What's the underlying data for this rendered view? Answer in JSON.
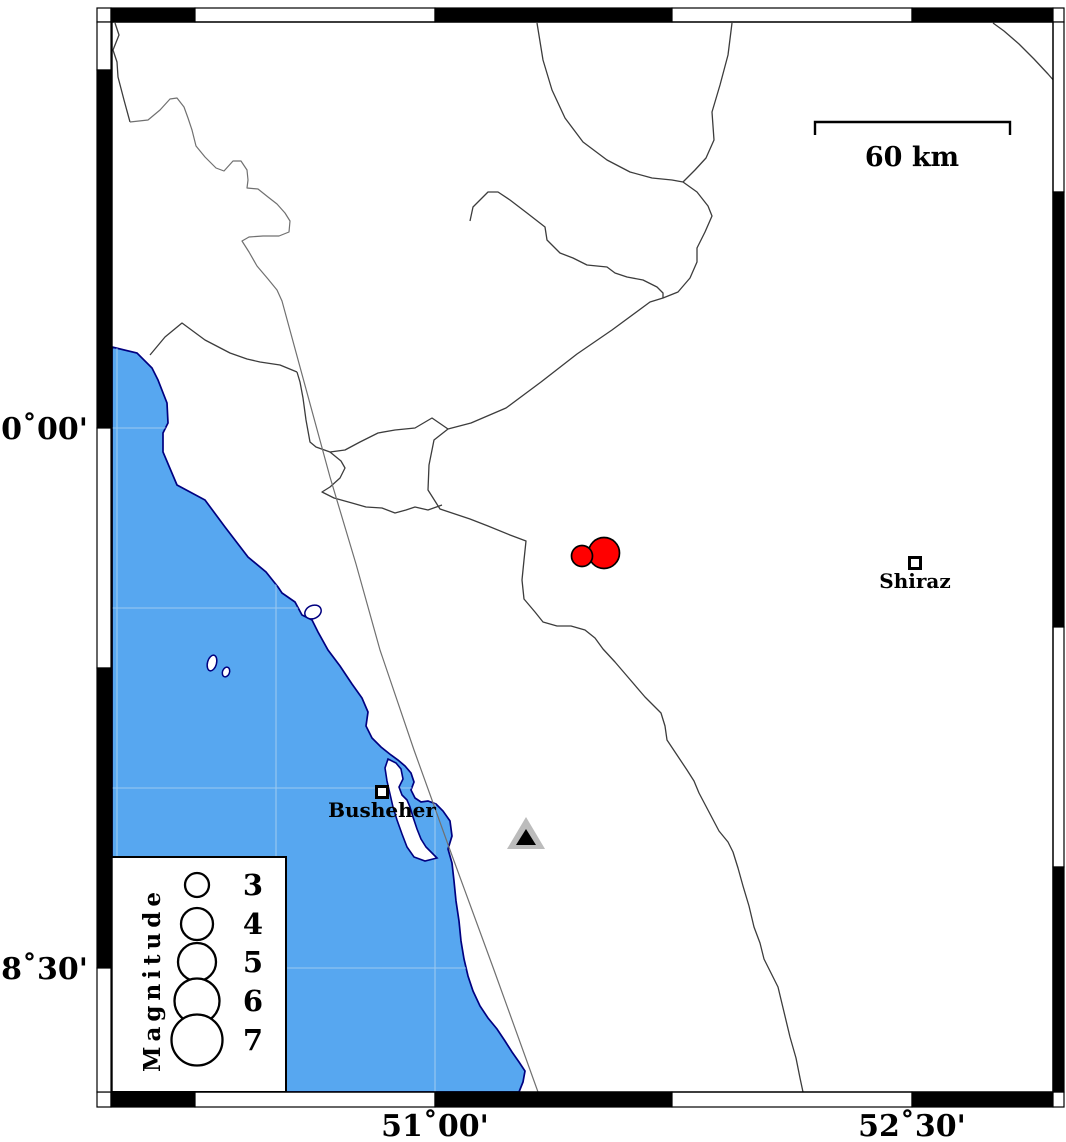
{
  "axis": {
    "left": [
      {
        "label": "30˚00'",
        "y": 428
      },
      {
        "label": "28˚30'",
        "y": 968
      }
    ],
    "bottom": [
      {
        "label": "51˚00'",
        "x": 435
      },
      {
        "label": "52˚30'",
        "x": 912
      }
    ]
  },
  "scale_bar": {
    "label": "60 km",
    "x1": 815,
    "x2": 1010,
    "y": 123
  },
  "legend": {
    "title": "Magnitude",
    "entries": [
      {
        "label": "3",
        "radius": 12,
        "cy": 885
      },
      {
        "label": "4",
        "radius": 16,
        "cy": 924
      },
      {
        "label": "5",
        "radius": 19,
        "cy": 962
      },
      {
        "label": "6",
        "radius": 22.5,
        "cy": 1001
      },
      {
        "label": "7",
        "radius": 25.5,
        "cy": 1040
      }
    ]
  },
  "cities": [
    {
      "name": "Busheher",
      "x": 382,
      "y": 792
    },
    {
      "name": "Shiraz",
      "x": 915,
      "y": 563
    }
  ],
  "earthquakes": [
    {
      "x": 604,
      "y": 553,
      "radius": 15.5,
      "approx_magnitude": 4.5
    },
    {
      "x": 582,
      "y": 556,
      "radius": 10.5,
      "approx_magnitude": 3.0
    }
  ],
  "stations": [
    {
      "x": 526,
      "y": 836,
      "type": "triangle"
    }
  ],
  "colors": {
    "sea": "#57A7F0",
    "land": "#FFFFFF",
    "coast_outline": "#000080",
    "border_line": "#3C3C3C",
    "fault_line": "#707070",
    "earthquake_fill": "#FF0000",
    "marker_outline": "#000000",
    "station_fill": "#BCBCBC",
    "station_inner": "#000000",
    "frame": "#000000",
    "grid_line": "#A8CFF0"
  }
}
